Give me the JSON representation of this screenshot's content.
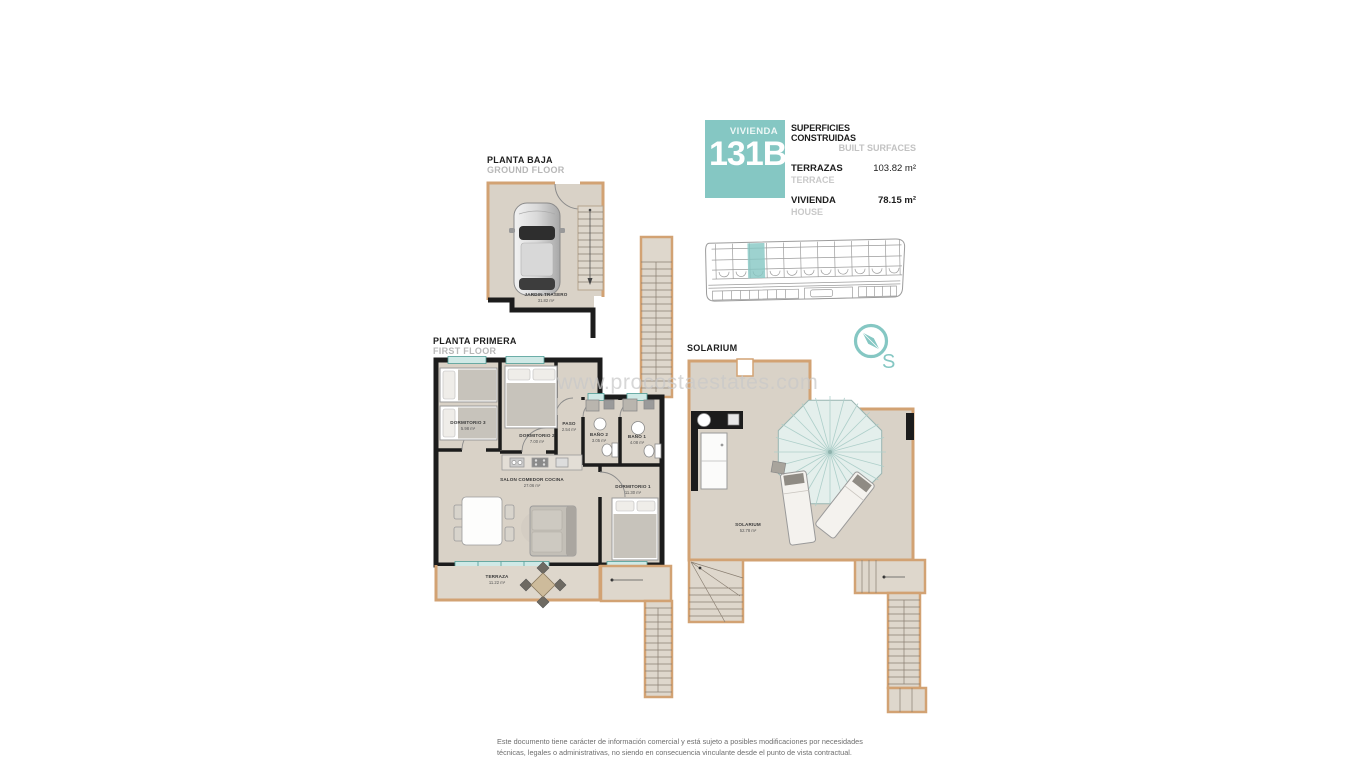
{
  "header": {
    "unit_label": "VIVIENDA",
    "unit_number": "131B",
    "surfaces_title_es": "SUPERFICIES CONSTRUIDAS",
    "surfaces_title_en": "BUILT SURFACES",
    "rows": [
      {
        "label_es": "TERRAZAS",
        "label_en": "TERRACE",
        "value": "103.82 m²"
      },
      {
        "label_es": "VIVIENDA",
        "label_en": "HOUSE",
        "value": "78.15 m²"
      }
    ]
  },
  "floors": {
    "ground": {
      "title_es": "PLANTA BAJA",
      "title_en": "GROUND FLOOR",
      "rooms": [
        {
          "name": "JARDIN TRASERO",
          "area": "31.82 m²"
        }
      ]
    },
    "first": {
      "title_es": "PLANTA PRIMERA",
      "title_en": "FIRST FLOOR",
      "rooms": [
        {
          "name": "DORMITORIO 3",
          "area": "5.98 m²"
        },
        {
          "name": "DORMITORIO 2",
          "area": "7.00 m²"
        },
        {
          "name": "PASO",
          "area": "2.54 m²"
        },
        {
          "name": "BAÑO 2",
          "area": "3.05 m²"
        },
        {
          "name": "BAÑO 1",
          "area": "4.08 m²"
        },
        {
          "name": "SALON COMEDOR COCINA",
          "area": "27.06 m²"
        },
        {
          "name": "DORMITORIO 1",
          "area": "11.30 m²"
        },
        {
          "name": "TERRAZA",
          "area": "11.22 m²"
        }
      ]
    },
    "solarium": {
      "title": "SOLARIUM",
      "rooms": [
        {
          "name": "SOLARIUM",
          "area": "52.78 m²"
        }
      ]
    }
  },
  "compass": {
    "south_label": "S"
  },
  "watermark": {
    "text": "www.procostaestates.com"
  },
  "disclaimer": {
    "text": "Este documento tiene carácter de información comercial y está sujeto a posibles modificaciones por necesidades técnicas, legales o administrativas, no siendo en consecuencia vinculante desde el punto de vista contractual."
  },
  "colors": {
    "teal": "#85c7c3",
    "wall_tan": "#d2a273",
    "floor_fill": "#d9d2c7",
    "wall_black": "#1c1c1c",
    "window_glass": "#cfe9e6",
    "muted_text": "#b8b8b8"
  }
}
